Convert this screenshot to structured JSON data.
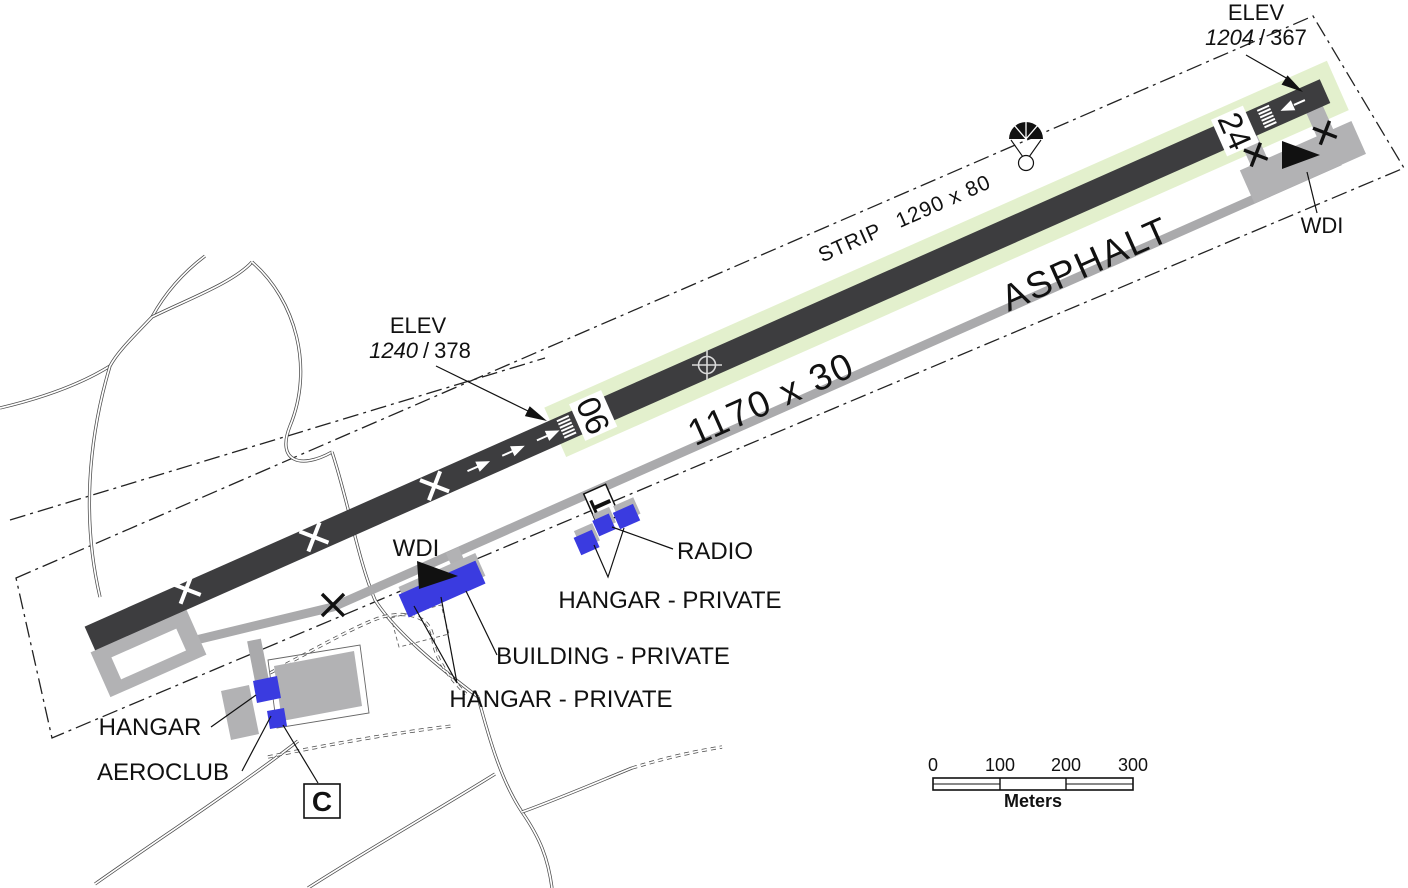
{
  "labels": {
    "elev_ne": {
      "title": "ELEV",
      "msl": "1204",
      "sep": "/",
      "agl": "367"
    },
    "elev_sw": {
      "title": "ELEV",
      "msl": "1240",
      "sep": "/",
      "agl": "378"
    },
    "strip_word": "STRIP",
    "strip_dims": "1290 x 80",
    "runway_dims": "1170 x 30",
    "surface": "ASPHALT",
    "rwy_06": "06",
    "rwy_24": "24",
    "wdi_ne": "WDI",
    "wdi_mid": "WDI",
    "signal_square": "T",
    "circuit_marker": "C",
    "radio": "RADIO",
    "hangar_private_ne": "HANGAR - PRIVATE",
    "building_private": "BUILDING - PRIVATE",
    "hangar_private_sw": "HANGAR - PRIVATE",
    "hangar": "HANGAR",
    "aeroclub": "AEROCLUB"
  },
  "scale_bar": {
    "ticks": [
      "0",
      "100",
      "200",
      "300"
    ],
    "unit": "Meters"
  },
  "colors": {
    "runway": "#3d3d3f",
    "strip": "#e3f0cd",
    "taxiway": "#aaaaac",
    "apron": "#b2b2b4",
    "building": "#3a3be0",
    "shadow": "#b4b4b6"
  }
}
